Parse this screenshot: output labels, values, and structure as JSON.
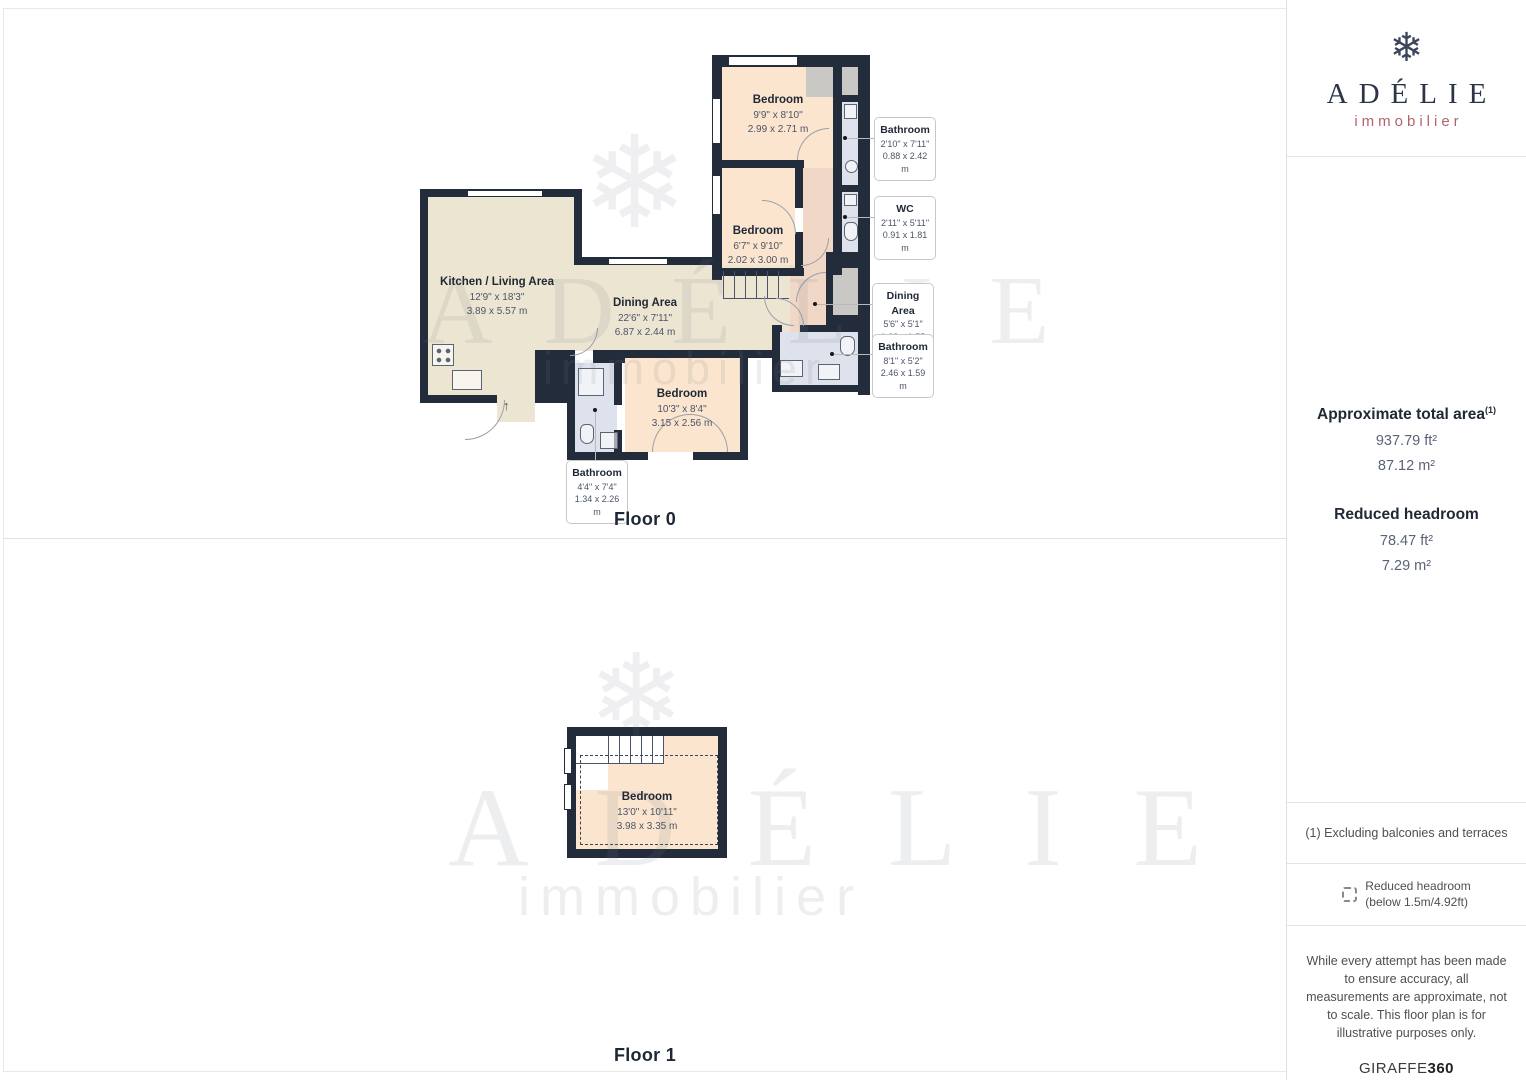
{
  "floor0": {
    "label": "Floor 0",
    "rooms": [
      {
        "name": "Bedroom",
        "dims_ft": "9'9\" x 8'10\"",
        "dims_m": "2.99 x 2.71 m"
      },
      {
        "name": "Bedroom",
        "dims_ft": "6'7\" x 9'10\"",
        "dims_m": "2.02 x 3.00 m"
      },
      {
        "name": "Kitchen / Living Area",
        "dims_ft": "12'9\" x 18'3\"",
        "dims_m": "3.89 x 5.57 m"
      },
      {
        "name": "Dining Area",
        "dims_ft": "22'6\" x 7'11\"",
        "dims_m": "6.87 x 2.44 m"
      },
      {
        "name": "Bedroom",
        "dims_ft": "10'3\" x 8'4\"",
        "dims_m": "3.15 x 2.56 m"
      }
    ],
    "callouts": [
      {
        "name": "Bathroom",
        "dims_ft": "2'10\" x 7'11\"",
        "dims_m": "0.88 x 2.42 m"
      },
      {
        "name": "WC",
        "dims_ft": "2'11\" x 5'11\"",
        "dims_m": "0.91 x 1.81 m"
      },
      {
        "name": "Dining Area",
        "dims_ft": "5'6\" x 5'1\"",
        "dims_m": "1.68 x 1.55 m"
      },
      {
        "name": "Bathroom",
        "dims_ft": "8'1\" x 5'2\"",
        "dims_m": "2.46 x 1.59 m"
      },
      {
        "name": "Bathroom",
        "dims_ft": "4'4\" x 7'4\"",
        "dims_m": "1.34 x 2.26 m"
      }
    ]
  },
  "floor1": {
    "label": "Floor 1",
    "rooms": [
      {
        "name": "Bedroom",
        "dims_ft": "13'0\" x 10'11\"",
        "dims_m": "3.98 x 3.35 m"
      }
    ]
  },
  "watermark": {
    "snowflake": "❄",
    "name": "A D É L I E",
    "tagline": "immobilier"
  },
  "sidebar": {
    "brand": {
      "snowflake": "❄",
      "name": "ADÉLIE",
      "tagline": "immobilier"
    },
    "total_area": {
      "title": "Approximate total area",
      "sup": "(1)",
      "ft": "937.79 ft²",
      "m": "87.12 m²"
    },
    "reduced_headroom": {
      "title": "Reduced headroom",
      "ft": "78.47 ft²",
      "m": "7.29 m²"
    },
    "footnote": "(1) Excluding balconies and terraces",
    "legend": {
      "line1": "Reduced headroom",
      "line2": "(below 1.5m/4.92ft)"
    },
    "disclaimer": "While every attempt has been made to ensure accuracy, all measurements are approximate, not to scale. This floor plan is for illustrative purposes only.",
    "vendor": {
      "name": "GIRAFFE",
      "suffix": "360"
    }
  },
  "colors": {
    "wall": "#222c3b",
    "bedroom": "#fbe5cf",
    "living": "#ece5d2",
    "bathroom": "#dde2ec",
    "hall": "#f1d7c6",
    "accent_rose": "#b2636b",
    "brand_navy": "#2c3448"
  }
}
